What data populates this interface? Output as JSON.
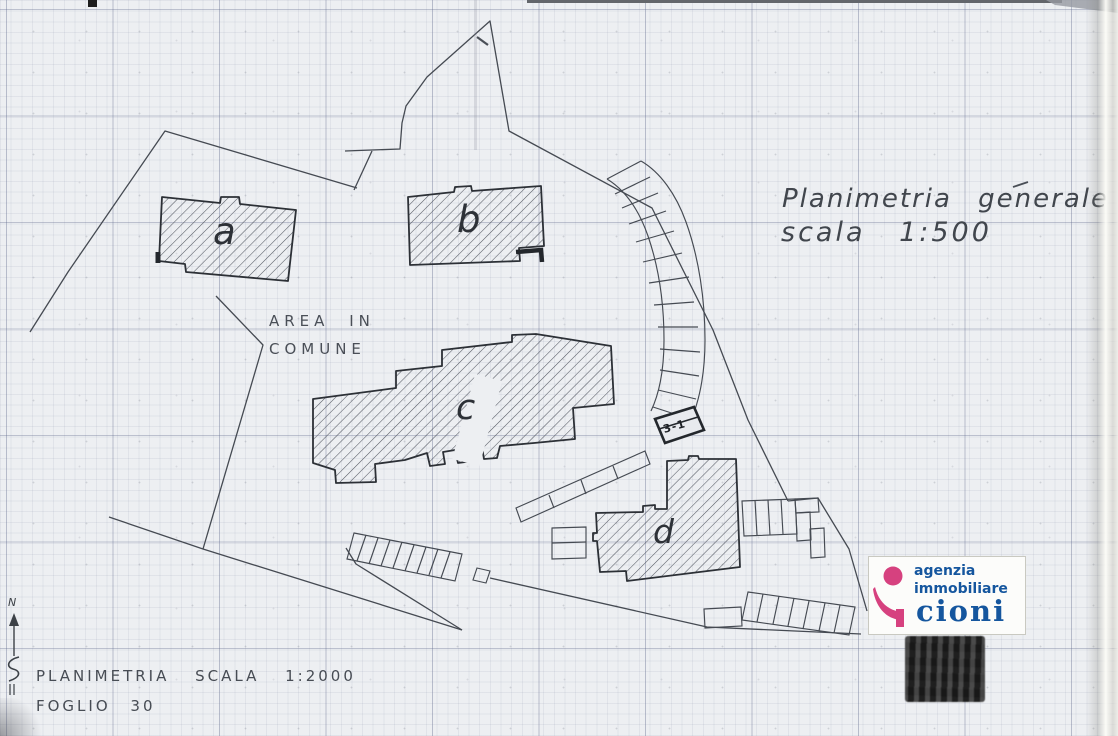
{
  "plan": {
    "title_line1": "Planimetria generale",
    "title_line2": "scala 1:500",
    "area_note_line1": "AREA IN",
    "area_note_line2": "COMUNE",
    "footer_line1": "PLANIMETRIA SCALA 1:2000",
    "footer_line2": "FOGLIO 30",
    "north_label": "N",
    "parcel_tag": "3-1",
    "buildings": [
      {
        "id": "a",
        "label": "a"
      },
      {
        "id": "b",
        "label": "b"
      },
      {
        "id": "c",
        "label": "c"
      },
      {
        "id": "d",
        "label": "d"
      }
    ]
  },
  "logo": {
    "line1": "agenzia",
    "line2": "immobiliare",
    "brand": "cioni",
    "accent_color": "#d6417f",
    "text_color": "#15569e"
  },
  "colors": {
    "paper": "#edeff2",
    "ink": "#35393f",
    "grid": "#9aa3bd"
  }
}
